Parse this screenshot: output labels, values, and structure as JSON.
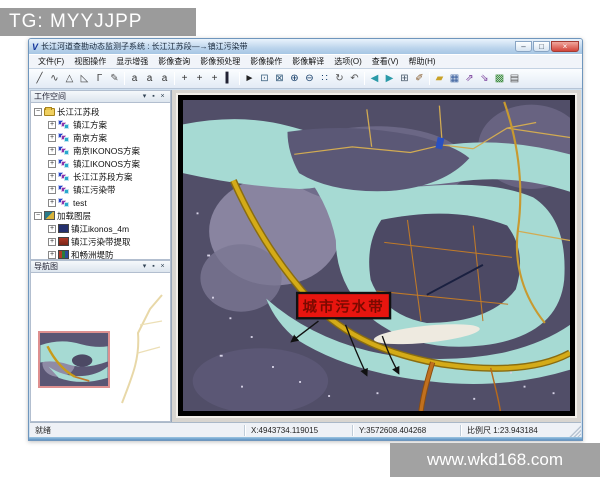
{
  "watermarks": {
    "top_left": "TG: MYYJJPP",
    "bottom_right": "www.wkd168.com"
  },
  "window": {
    "icon_glyph": "V",
    "title": "长江河道查勘动态监测子系统 : 长江江苏段—→镇江污染带",
    "minimize": "–",
    "maximize": "□",
    "close": "×"
  },
  "menu": [
    "文件(F)",
    "视图操作",
    "显示增强",
    "影像查询",
    "影像预处理",
    "影像操作",
    "影像解译",
    "选项(O)",
    "查看(V)",
    "帮助(H)"
  ],
  "toolbar": [
    {
      "name": "draw-line-tool",
      "glyph": "╱",
      "color": "#444"
    },
    {
      "name": "draw-curve-tool",
      "glyph": "∿",
      "color": "#444"
    },
    {
      "name": "draw-polygon-tool",
      "glyph": "△",
      "color": "#444"
    },
    {
      "name": "draw-triangle-tool",
      "glyph": "◺",
      "color": "#444"
    },
    {
      "name": "draw-angle-tool",
      "glyph": "Γ",
      "color": "#444"
    },
    {
      "name": "pencil-tool",
      "glyph": "✎",
      "color": "#555"
    },
    {
      "sep": true
    },
    {
      "name": "label-small-tool",
      "glyph": "a",
      "color": "#333"
    },
    {
      "name": "label-medium-tool",
      "glyph": "a",
      "color": "#333"
    },
    {
      "name": "label-large-tool",
      "glyph": "a",
      "color": "#333"
    },
    {
      "sep": true
    },
    {
      "name": "point-tool",
      "glyph": "+",
      "color": "#333"
    },
    {
      "name": "multipoint-tool",
      "glyph": "+",
      "color": "#333"
    },
    {
      "name": "point-label-tool",
      "glyph": "+",
      "color": "#333"
    },
    {
      "name": "bar-tool",
      "glyph": "▍",
      "color": "#223"
    },
    {
      "sep": true
    },
    {
      "name": "select-pointer-tool",
      "glyph": "►",
      "color": "#222"
    },
    {
      "name": "zoom-window-tool",
      "glyph": "⊡",
      "color": "#335a7a"
    },
    {
      "name": "full-extent-tool",
      "glyph": "⊠",
      "color": "#335a7a"
    },
    {
      "name": "zoom-in-tool",
      "glyph": "⊕",
      "color": "#123a66"
    },
    {
      "name": "zoom-out-tool",
      "glyph": "⊖",
      "color": "#123a66"
    },
    {
      "name": "grid-points-tool",
      "glyph": "∷",
      "color": "#123a66"
    },
    {
      "name": "pan-tool",
      "glyph": "↻",
      "color": "#555"
    },
    {
      "name": "undo-tool",
      "glyph": "↶",
      "color": "#555"
    },
    {
      "sep": true
    },
    {
      "name": "back-arrow-tool",
      "glyph": "◀",
      "color": "#2a9aa8"
    },
    {
      "name": "forward-arrow-tool",
      "glyph": "▶",
      "color": "#2a9aa8"
    },
    {
      "name": "tile-windows-tool",
      "glyph": "⊞",
      "color": "#456"
    },
    {
      "name": "brush-tool",
      "glyph": "✐",
      "color": "#865a2a"
    },
    {
      "sep": true
    },
    {
      "name": "open-folder-tool",
      "glyph": "▰",
      "color": "#c9a227"
    },
    {
      "name": "save-tool",
      "glyph": "▦",
      "color": "#335a9a"
    },
    {
      "name": "export-tool",
      "glyph": "⇗",
      "color": "#7a3f9a"
    },
    {
      "name": "import-tool",
      "glyph": "⇘",
      "color": "#7a3f9a"
    },
    {
      "name": "image-tool",
      "glyph": "▩",
      "color": "#3a8a3a"
    },
    {
      "name": "print-tool",
      "glyph": "▤",
      "color": "#555"
    }
  ],
  "workspace": {
    "title": "工作空间",
    "dropdown_glyph": "▾",
    "pin_glyph": "▪",
    "close_glyph": "×",
    "root": "长江江苏段",
    "schemes": [
      "镇江方案",
      "南京方案",
      "南京IKONOS方案",
      "镇江IKONOS方案",
      "长江江苏段方案",
      "镇江污染带",
      "test"
    ],
    "layers_root": "加载图层",
    "layers": [
      "镇江ikonos_4m",
      "镇江污染带提取",
      "和畅洲堤防"
    ]
  },
  "navigation": {
    "title": "导航图",
    "dropdown_glyph": "▾",
    "pin_glyph": "▪",
    "close_glyph": "×"
  },
  "map": {
    "annotation_label": "城市污水带"
  },
  "status": {
    "ready": "就绪",
    "x": "X:4943734.119015",
    "y": "Y:3572608.404268",
    "scale": "比例尺 1:23.943184"
  },
  "colors": {
    "water": "#a6dad3",
    "land": "#514e68",
    "road": "#d4ab18",
    "label_bg": "#e8150f",
    "label_text": "#7a0a00"
  }
}
